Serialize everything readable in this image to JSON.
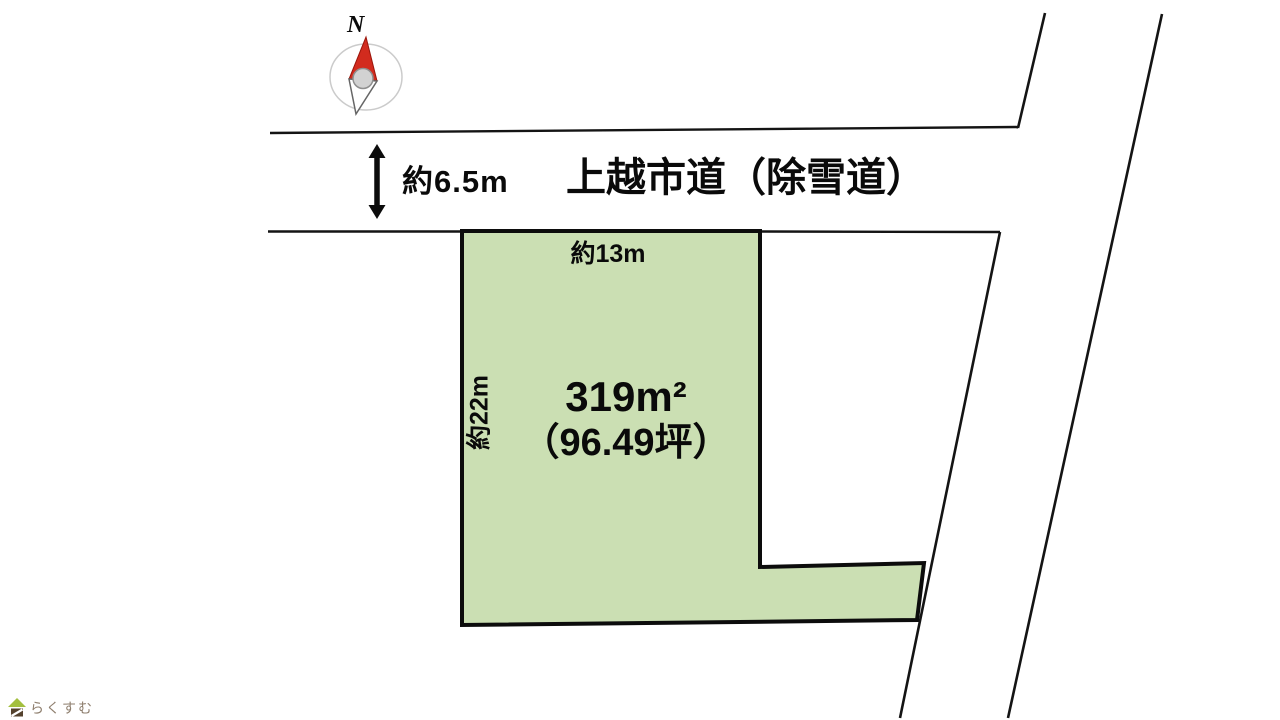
{
  "compass": {
    "north_label": "N"
  },
  "road": {
    "width_label": "約6.5m",
    "name": "上越市道（除雪道）"
  },
  "plot": {
    "frontage_label": "約13m",
    "depth_label": "約22m",
    "area_sqm": "319m²",
    "area_tsubo": "（96.49坪）"
  },
  "logo": {
    "text": "らくすむ"
  },
  "colors": {
    "plot_fill": "#cbdfb3",
    "line": "#111111",
    "needle_red": "#d22b1e",
    "needle_red_outline": "#9b150b",
    "logo_roof_green": "#a3bf3f",
    "logo_body_brown": "#54422e",
    "logo_text_brown": "#8e7e6d"
  }
}
